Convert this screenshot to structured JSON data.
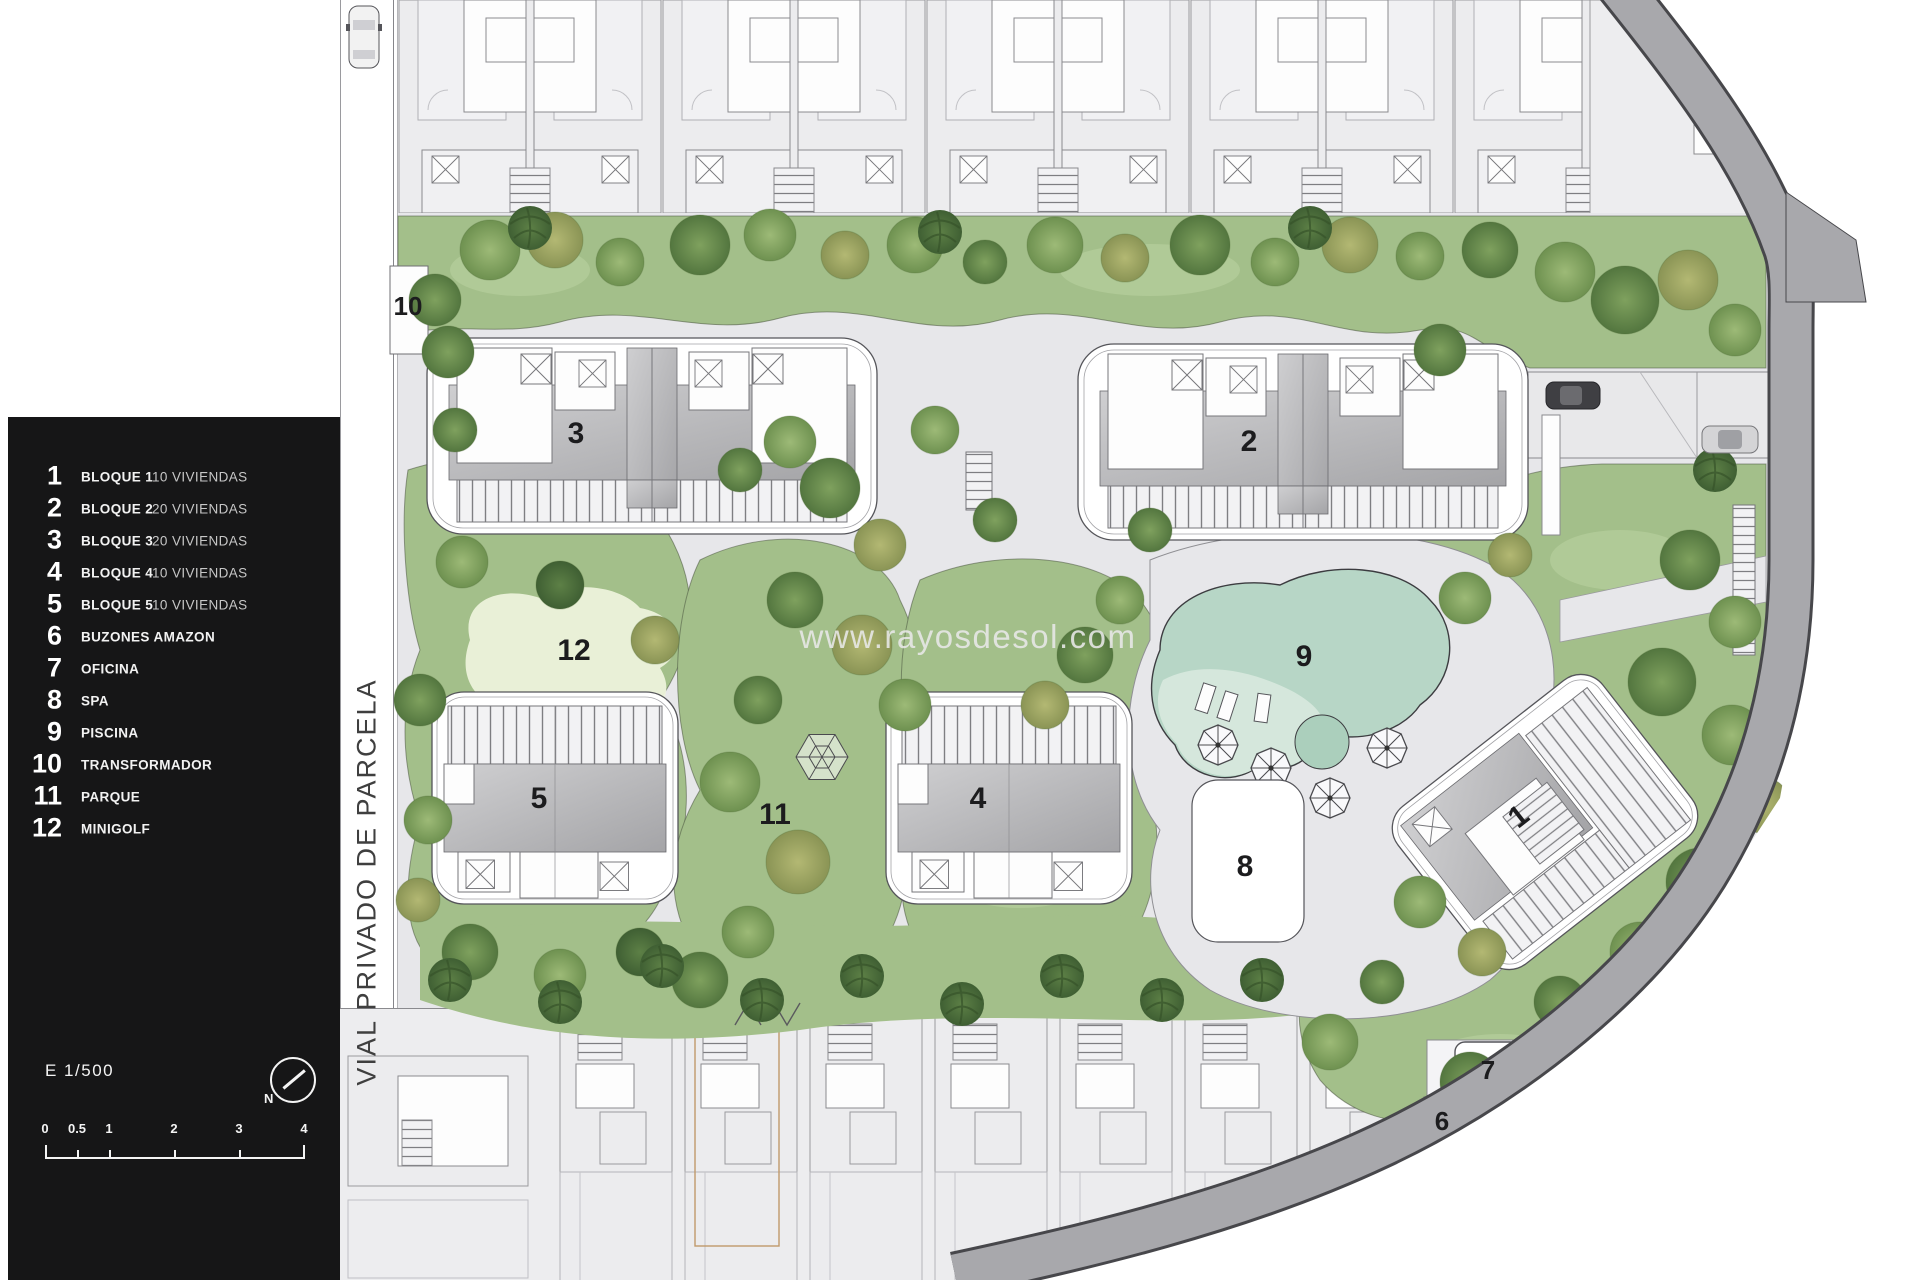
{
  "watermark": "www.rayosdesol.com",
  "road_label": "VIAL PRIVADO DE PARCELA",
  "legend": {
    "items": [
      {
        "num": "1",
        "label": "BLOQUE 1",
        "detail": "10 VIVIENDAS"
      },
      {
        "num": "2",
        "label": "BLOQUE 2",
        "detail": "20 VIVIENDAS"
      },
      {
        "num": "3",
        "label": "BLOQUE 3",
        "detail": "20 VIVIENDAS"
      },
      {
        "num": "4",
        "label": "BLOQUE 4",
        "detail": "10 VIVIENDAS"
      },
      {
        "num": "5",
        "label": "BLOQUE 5",
        "detail": "10 VIVIENDAS"
      },
      {
        "num": "6",
        "label": "BUZONES AMAZON",
        "detail": ""
      },
      {
        "num": "7",
        "label": "OFICINA",
        "detail": ""
      },
      {
        "num": "8",
        "label": "SPA",
        "detail": ""
      },
      {
        "num": "9",
        "label": "PISCINA",
        "detail": ""
      },
      {
        "num": "10",
        "label": "TRANSFORMADOR",
        "detail": ""
      },
      {
        "num": "11",
        "label": "PARQUE",
        "detail": ""
      },
      {
        "num": "12",
        "label": "MINIGOLF",
        "detail": ""
      }
    ]
  },
  "scale": {
    "text": "E 1/500",
    "north": "N",
    "ticks": [
      "0",
      "0.5",
      "1",
      "2",
      "3",
      "4"
    ]
  },
  "plan": {
    "labels": {
      "l1": "1",
      "l2": "2",
      "l3": "3",
      "l4": "4",
      "l5": "5",
      "l6": "6",
      "l7": "7",
      "l8": "8",
      "l9": "9",
      "l10": "10",
      "l11": "11",
      "l12": "12"
    }
  },
  "colors": {
    "legend_bg": "#161617",
    "grass": "#a3bf8a",
    "pool_water": "#b7d6c6",
    "road_band": "#a8a8ac",
    "paths": "#e7e7ea"
  }
}
